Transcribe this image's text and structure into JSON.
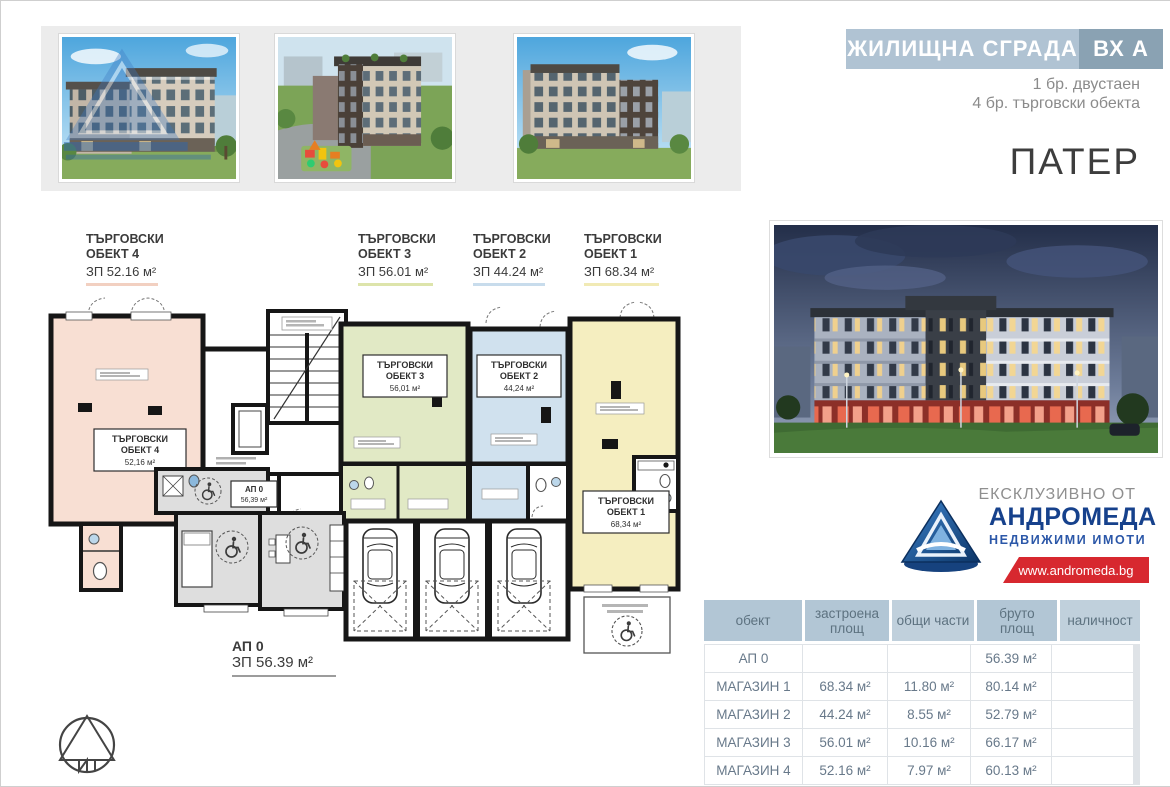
{
  "header": {
    "building_title": "ЖИЛИЩНА СГРАДА",
    "entrance": "ВХ А",
    "unit_mix_line1": "1 бр. двустаен",
    "unit_mix_line2": "4 бр. търговски обекта",
    "floor_title": "ПАТЕР",
    "band_color_light": "#b0c3d3",
    "band_color_dark": "#8aa2b3"
  },
  "plan": {
    "top_labels": [
      {
        "line1": "ТЪРГОВСКИ",
        "line2": "ОБЕКТ 4",
        "area": "ЗП 52.16 м²",
        "color": "#f2d0c1"
      },
      {
        "line1": "ТЪРГОВСКИ",
        "line2": "ОБЕКТ 3",
        "area": "ЗП 56.01 м²",
        "color": "#dde4ab"
      },
      {
        "line1": "ТЪРГОВСКИ",
        "line2": "ОБЕКТ 2",
        "area": "ЗП 44.24 м²",
        "color": "#c8dcec"
      },
      {
        "line1": "ТЪРГОВСКИ",
        "line2": "ОБЕКТ 1",
        "area": "ЗП 68.34 м²",
        "color": "#f1eab5"
      }
    ],
    "units": [
      {
        "line1": "ТЪРГОВСКИ",
        "line2": "ОБЕКТ 4",
        "area": "52,16 м²",
        "fill": "#f8dfd3"
      },
      {
        "line1": "ТЪРГОВСКИ",
        "line2": "ОБЕКТ 3",
        "area": "56,01 м²",
        "fill": "#e1e9c5"
      },
      {
        "line1": "ТЪРГОВСКИ",
        "line2": "ОБЕКТ 2",
        "area": "44,24 м²",
        "fill": "#d0e1ee"
      },
      {
        "line1": "ТЪРГОВСКИ",
        "line2": "ОБЕКТ 1",
        "area": "68,34 м²",
        "fill": "#f5eec0"
      }
    ],
    "apartment": {
      "name": "АП 0",
      "area": "56,39 м²"
    },
    "caption": {
      "name": "АП 0",
      "area": "ЗП 56.39 м²"
    }
  },
  "branding": {
    "exclusive_label": "ЕКСКЛУЗИВНО ОТ",
    "company": "АНДРОМЕДА",
    "company_sub": "НЕДВИЖИМИ ИМОТИ",
    "website": "www.andromeda.bg",
    "brand_blue": "#16418c",
    "brand_red": "#d7282f"
  },
  "table": {
    "headers": [
      "обект",
      "застроена\nплощ",
      "общи части",
      "бруто\nплощ",
      "наличност"
    ],
    "rows": [
      {
        "object": "АП 0",
        "built_area": "",
        "common_parts": "",
        "gross_area": "56.39 м²",
        "availability": ""
      },
      {
        "object": "МАГАЗИН 1",
        "built_area": "68.34 м²",
        "common_parts": "11.80 м²",
        "gross_area": "80.14 м²",
        "availability": ""
      },
      {
        "object": "МАГАЗИН 2",
        "built_area": "44.24 м²",
        "common_parts": "8.55 м²",
        "gross_area": "52.79 м²",
        "availability": ""
      },
      {
        "object": "МАГАЗИН 3",
        "built_area": "56.01 м²",
        "common_parts": "10.16 м²",
        "gross_area": "66.17 м²",
        "availability": ""
      },
      {
        "object": "МАГАЗИН 4",
        "built_area": "52.16 м²",
        "common_parts": "7.97 м²",
        "gross_area": "60.13 м²",
        "availability": ""
      }
    ]
  }
}
